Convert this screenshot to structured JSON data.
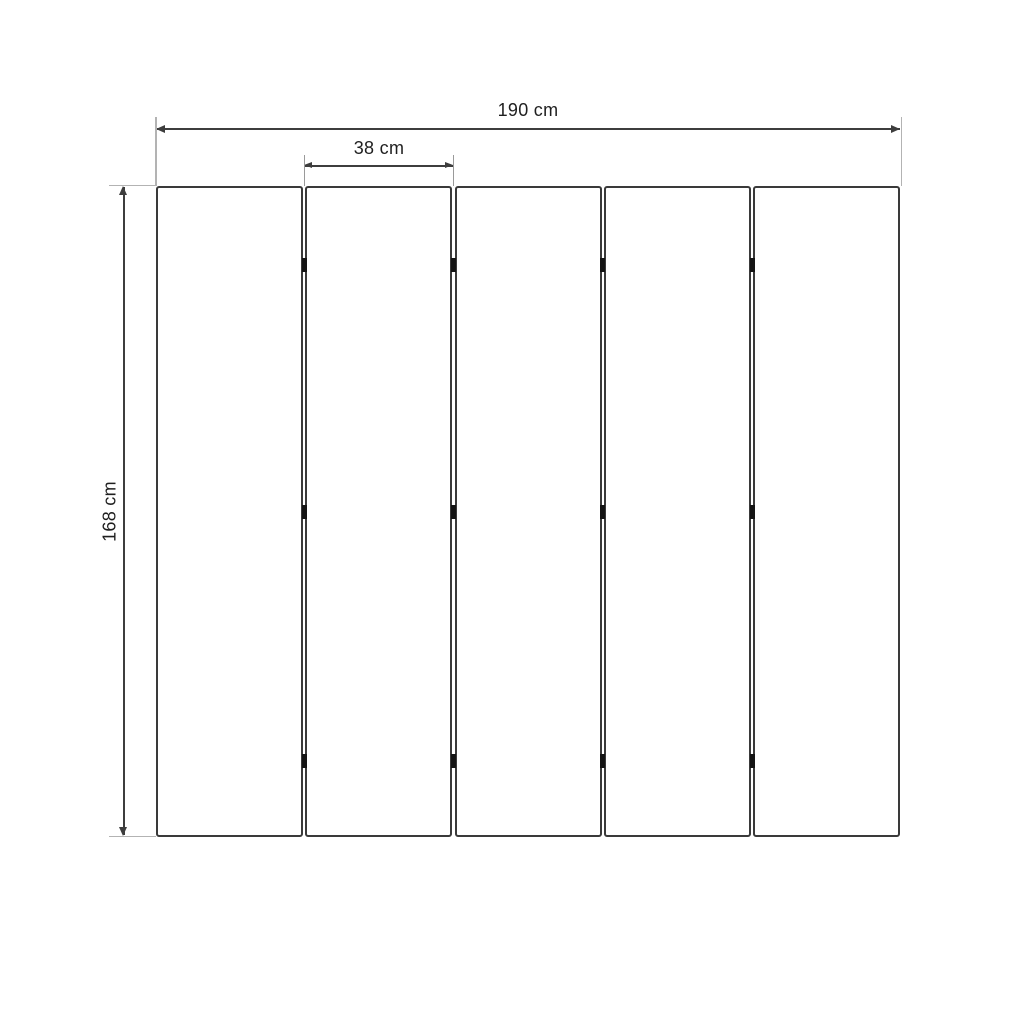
{
  "drawing": {
    "type": "dimensioned technical drawing",
    "subject": "5-panel folding screen, front view",
    "panel_count": 5,
    "hinge_rows": 3,
    "labels": {
      "total_width": "190 cm",
      "panel_width": "38 cm",
      "height": "168 cm"
    },
    "colors": {
      "line": "#3d3d3d",
      "extension_line": "#b3b3b3",
      "hinge": "#141414",
      "text": "#1f1f1f",
      "background": "#ffffff"
    }
  }
}
